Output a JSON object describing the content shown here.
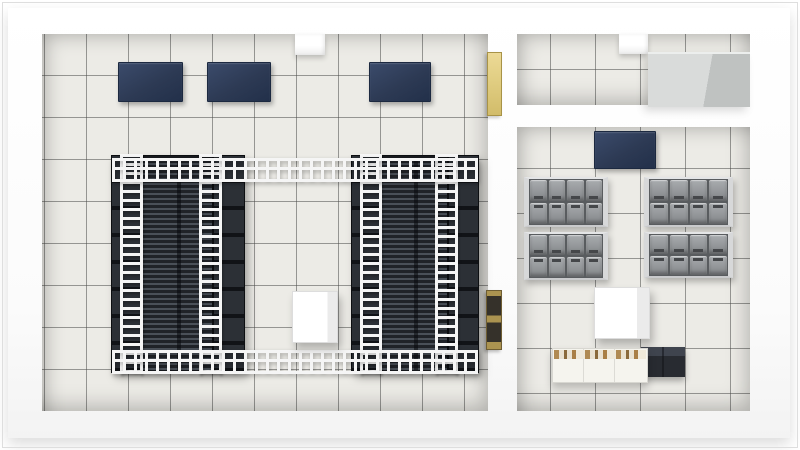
{
  "canvas": {
    "width": 800,
    "height": 450,
    "background": "#ffffff"
  },
  "palette": {
    "floor-tile": "#ecebe6",
    "floor-grout": "#6f6f6d",
    "wall": "#ffffff",
    "navy": "#2d3a54",
    "rack-base": "#17191d",
    "rack-face": "#2c3036",
    "vent-light": "#4a5058",
    "vent-dark": "#202328",
    "tray": "#f5f5f5",
    "battery": "#94979a",
    "battery-frame": "#d7d8d9",
    "yellow": "#e2cf84",
    "brass": "#ab9350",
    "gray-unit-top": "#d9dbda",
    "gray-unit-side": "#bfc2c1",
    "crate": "#f5f4ee",
    "crate-contents": "#a97f46",
    "dark-box": "#282b31"
  },
  "rooms": [
    {
      "name": "main-server-room-floor",
      "floor": {
        "x": 42,
        "y": 34,
        "w": 446,
        "h": 377
      },
      "tile_size": 42,
      "tile_offset": "2px -1px"
    },
    {
      "name": "utility-room-floor",
      "floor": {
        "x": 517,
        "y": 34,
        "w": 233,
        "h": 71
      },
      "tile_size": 45,
      "tile_offset": "-12px -10px"
    },
    {
      "name": "battery-equipment-room-floor",
      "floor": {
        "x": 517,
        "y": 127,
        "w": 233,
        "h": 284
      },
      "tile_size": 45,
      "tile_offset": "-12px -4px"
    }
  ],
  "items": [
    {
      "type": "wall-column",
      "name": "wall-column-main-room",
      "x": 295,
      "y": 34,
      "w": 30,
      "h": 21
    },
    {
      "type": "wall-column",
      "name": "wall-column-utility-room",
      "x": 619,
      "y": 34,
      "w": 29,
      "h": 20
    },
    {
      "type": "navy-panel",
      "name": "ac-unit-1",
      "x": 118,
      "y": 62,
      "w": 63,
      "h": 38
    },
    {
      "type": "navy-panel",
      "name": "ac-unit-2",
      "x": 207,
      "y": 62,
      "w": 62,
      "h": 38
    },
    {
      "type": "navy-panel",
      "name": "ac-unit-3",
      "x": 369,
      "y": 62,
      "w": 60,
      "h": 38
    },
    {
      "type": "rack-group",
      "name": "server-rack-row-left",
      "x": 112,
      "y": 156,
      "w": 132,
      "h": 216
    },
    {
      "type": "rack-group",
      "name": "server-rack-row-right",
      "x": 352,
      "y": 156,
      "w": 126,
      "h": 216
    },
    {
      "type": "htray",
      "name": "cable-tray-top",
      "x": 112,
      "y": 158,
      "w": 366,
      "h": 18
    },
    {
      "type": "htray",
      "name": "cable-tray-bottom",
      "x": 112,
      "y": 350,
      "w": 366,
      "h": 18
    },
    {
      "type": "white-box",
      "name": "floor-unit-main-room",
      "x": 292,
      "y": 291,
      "w": 44,
      "h": 50
    },
    {
      "type": "yellow-panel",
      "name": "electrical-panel-upper",
      "x": 487,
      "y": 52,
      "w": 13,
      "h": 62
    },
    {
      "type": "brass-panel",
      "name": "electrical-panel-lower",
      "x": 486,
      "y": 290,
      "w": 14,
      "h": 58
    },
    {
      "type": "gray-unit",
      "name": "air-handler-unit",
      "x": 648,
      "y": 52,
      "w": 102,
      "h": 53
    },
    {
      "type": "navy-panel",
      "name": "ac-unit-4",
      "x": 594,
      "y": 131,
      "w": 60,
      "h": 36
    },
    {
      "type": "battery-rack",
      "name": "battery-rack-1",
      "x": 524,
      "y": 177,
      "w": 74,
      "h": 46
    },
    {
      "type": "battery-rack",
      "name": "battery-rack-2",
      "x": 644,
      "y": 177,
      "w": 79,
      "h": 46
    },
    {
      "type": "battery-rack",
      "name": "battery-rack-3",
      "x": 524,
      "y": 232,
      "w": 74,
      "h": 44
    },
    {
      "type": "battery-rack",
      "name": "battery-rack-4",
      "x": 644,
      "y": 232,
      "w": 79,
      "h": 42
    },
    {
      "type": "white-cube",
      "name": "storage-cube",
      "x": 594,
      "y": 287,
      "w": 54,
      "h": 50
    },
    {
      "type": "dark-box",
      "name": "dark-storage-boxes",
      "x": 641,
      "y": 347,
      "w": 44,
      "h": 30
    },
    {
      "type": "crate-row",
      "name": "storage-crates",
      "x": 552,
      "y": 348,
      "w": 94,
      "h": 33
    }
  ]
}
